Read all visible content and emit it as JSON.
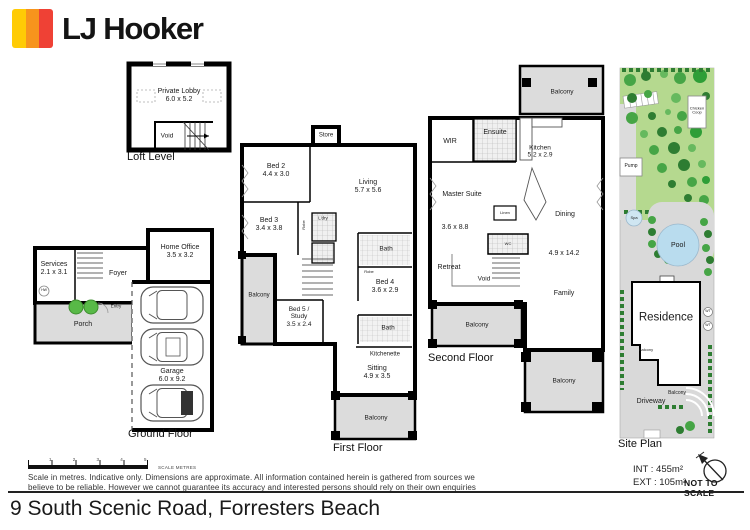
{
  "brand": {
    "name": "LJ Hooker",
    "stripe_colors": [
      "#FFCB05",
      "#F7941D",
      "#EF4135"
    ]
  },
  "address": "9 South Scenic Road, Forresters Beach",
  "footer": {
    "scale_numbers": "1 2 3 4 5",
    "scale_label": "SCALE METRES",
    "disclaimer_line1": "Scale in metres. Indicative only. Dimensions are approximate. All information contained herein is gathered from sources we",
    "disclaimer_line2": "believe to be reliable. However we cannot guarantee its accuracy and interested persons should rely on their own enquiries",
    "int_area": "INT : 455m²",
    "ext_area": "EXT : 105m²",
    "not_to_scale": "NOT TO SCALE"
  },
  "plans": {
    "loft": {
      "title": "Loft Level",
      "private_lobby": {
        "name": "Private Lobby",
        "dims": "6.0 x 5.2"
      },
      "void_label": "Void"
    },
    "ground": {
      "title": "Ground Floor",
      "services": {
        "name": "Services",
        "dims": "2.1 x 3.1"
      },
      "foyer": "Foyer",
      "home_office": {
        "name": "Home Office",
        "dims": "3.5 x 3.2"
      },
      "porch": "Porch",
      "entry": "Entry",
      "hw": "HW",
      "garage": {
        "name": "Garage",
        "dims": "6.0 x 9.2"
      }
    },
    "first": {
      "title": "First Floor",
      "store": "Store",
      "bed2": {
        "name": "Bed 2",
        "dims": "4.4 x 3.0"
      },
      "living": {
        "name": "Living",
        "dims": "5.7 x 5.6"
      },
      "bed3": {
        "name": "Bed 3",
        "dims": "3.4 x 3.8"
      },
      "ldry": "L'dry",
      "robe": "Robe",
      "bath_upper": "Bath",
      "bed4": {
        "name": "Bed 4",
        "dims": "3.6 x 2.9"
      },
      "balcony_left": "Balcony",
      "bed5": {
        "line1": "Bed 5 /",
        "line2": "Study",
        "dims": "3.5 x 2.4"
      },
      "bath_lower": "Bath",
      "kitchenette": "Kitchenette",
      "sitting": {
        "name": "Sitting",
        "dims": "4.9 x 3.5"
      },
      "balcony_bottom": "Balcony"
    },
    "second": {
      "title": "Second Floor",
      "balcony_top": "Balcony",
      "wir": "WIR",
      "ensuite": "Ensuite",
      "kitchen": {
        "name": "Kitchen",
        "dims": "5.2 x 2.9"
      },
      "master": {
        "name": "Master Suite",
        "dims": "3.6 x 8.8"
      },
      "linen": "Linen",
      "wc": "WC",
      "dining": "Dining",
      "family_dims": "4.9 x 14.2",
      "retreat": "Retreat",
      "void_label": "Void",
      "family": "Family",
      "balcony_left": "Balcony",
      "balcony_bottom": "Balcony"
    },
    "site": {
      "title": "Site Plan",
      "chicken_coop": {
        "line1": "Chicken",
        "line2": "Coop"
      },
      "pump": "Pump",
      "spa": "Spa",
      "pool": "Pool",
      "residence": "Residence",
      "balcony_left": "Balcony",
      "balcony_bottom": "Balcony",
      "wt": "WT",
      "driveway": "Driveway"
    }
  }
}
